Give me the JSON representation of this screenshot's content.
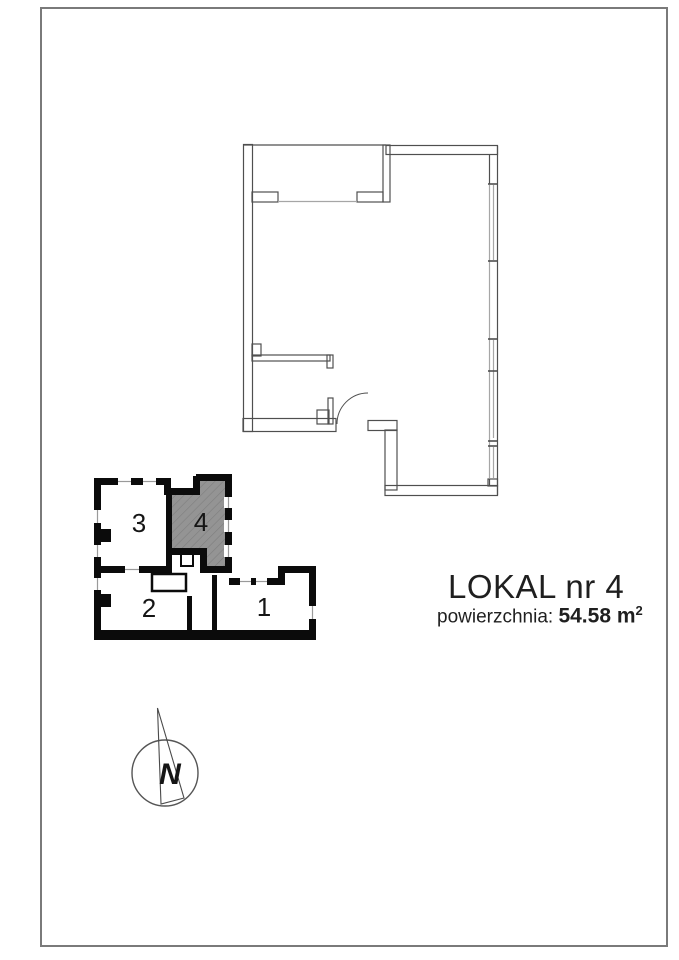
{
  "page": {
    "background": "#ffffff",
    "border_color": "#7a7a7a"
  },
  "main_plan": {
    "wall_color": "#4f4f4f",
    "window_color": "#a6a6a6"
  },
  "key_plan": {
    "wall_color": "#0b0b0b",
    "highlight_color": "#949494",
    "hatch_color": "#7e7e7e",
    "highlighted_unit": "4",
    "units": [
      {
        "label": "1"
      },
      {
        "label": "2"
      },
      {
        "label": "3"
      },
      {
        "label": "4"
      }
    ]
  },
  "north_arrow": {
    "label": "N"
  },
  "caption": {
    "title": "LOKAL nr 4",
    "area_label": "powierzchnia:",
    "area_value": "54.58 m",
    "area_exponent": "2"
  }
}
